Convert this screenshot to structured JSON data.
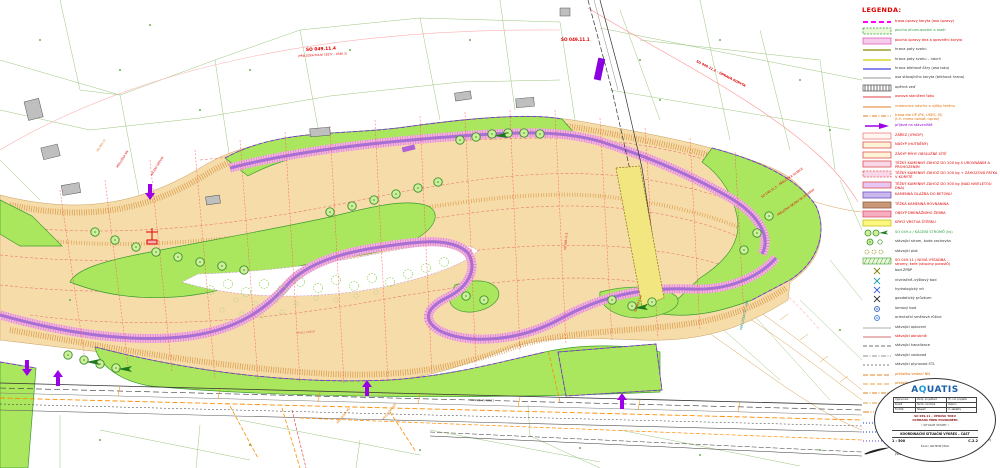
{
  "colors": {
    "corridor_fill": "#F6DCA8",
    "hatch_orange": "#D89848",
    "green_area": "#ABE65F",
    "green_border": "#3C9B2F",
    "riprap_pink": "#F2B6E2",
    "riprap_tick": "#E07FB8",
    "channel_violet": "#A86FD4",
    "arrow_purple": "#9B00E8",
    "annotation_red": "#E00000",
    "utility_orange": "#E07000",
    "road_yellow": "#F2E680",
    "cadastre_green": "#8FBF6F",
    "axis_pink": "#FF9090",
    "building_grey": "#BFBFBF",
    "teal_note": "#109090"
  },
  "legend": {
    "title": "LEGENDA:",
    "items": [
      {
        "sw": {
          "k": "dash",
          "c": "#FF00FF",
          "w": 2,
          "d": "5,3"
        },
        "t": "trasa úpravy koryta (osa úpravy)",
        "tc": "#E00000"
      },
      {
        "sw": {
          "k": "rectdash",
          "f": "#EAF7D8",
          "c": "#2E9E40"
        },
        "t": "plocha ohumusování a osetí",
        "tc": "#2E9E40"
      },
      {
        "sw": {
          "k": "rect",
          "f": "#F6CCEA",
          "c": "#E060C0"
        },
        "t": "plocha úpravy dna a opevnění koryta",
        "tc": "#E00000"
      },
      {
        "sw": {
          "k": "line",
          "c": "#8A8A00",
          "w": 1.2
        },
        "t": "hrana paty svahu",
        "tc": "#333333"
      },
      {
        "sw": {
          "k": "line",
          "c": "#CFCF00",
          "w": 1.2
        },
        "t": "hrana paty svahu – návrh",
        "tc": "#333333"
      },
      {
        "sw": {
          "k": "line",
          "c": "#4040E0",
          "w": 1.2
        },
        "t": "hrana břehové čáry (osa toku)",
        "tc": "#333333"
      },
      {
        "sw": {
          "k": "line",
          "c": "#707070",
          "w": 0.8
        },
        "t": "osa stávajícího koryta (břehová hrana)",
        "tc": "#333333"
      },
      {
        "sw": {
          "k": "hatch"
        },
        "t": "opěrná zeď",
        "tc": "#333333"
      },
      {
        "sw": {
          "k": "line",
          "c": "#E04040",
          "w": 1
        },
        "t": "osnova staničení toku",
        "tc": "#E00000"
      },
      {
        "sw": {
          "k": "line",
          "c": "#E08020",
          "w": 1
        },
        "t": "vrstevnice návrhu a výšky terénu",
        "tc": "#E07000"
      },
      {
        "sw": {
          "k": "dashdot",
          "c": "#E08020",
          "w": 1
        },
        "t": "trasa dle ÚP (PK, ÚSES, IS)\n(t.č. mimo rozsah úprav)",
        "tc": "#E07000"
      },
      {
        "sw": {
          "k": "arrow"
        },
        "t": "příjezd na staveniště",
        "tc": "#9400D3"
      },
      {
        "sw": {
          "k": "rect",
          "f": "#FFF6F0",
          "c": "#F08080"
        },
        "t": "ZÁŘEZ (VÝKOP)",
        "tc": "#E00000"
      },
      {
        "sw": {
          "k": "rect",
          "f": "#FDF3D8",
          "c": "#E05050"
        },
        "t": "NÁSYP (HUTNĚNÝ)",
        "tc": "#E00000"
      },
      {
        "sw": {
          "k": "rect",
          "f": "#FDF3D8",
          "c": "#E05050"
        },
        "t": "ZÁSYP RÝHY OBSLUŽNÉ SÍTĚ",
        "tc": "#E00000"
      },
      {
        "sw": {
          "k": "rect",
          "f": "#F8D8E8",
          "c": "#E05050"
        },
        "t": "TĚŽKÝ KAMENNÝ ZÁHOZ DO 200 kg S UROVNÁNÍM A PROHOZENÍM",
        "tc": "#E00000"
      },
      {
        "sw": {
          "k": "rectdash",
          "f": "#F8D8E8",
          "c": "#E05050"
        },
        "t": "TĚŽKÝ KAMENNÝ ZÁHOZ DO 200 kg + ZÁHOZOVÁ PATKA V KORYTĚ",
        "tc": "#E00000"
      },
      {
        "sw": {
          "k": "rect",
          "f": "#E6C6F2",
          "c": "#E05050"
        },
        "t": "TĚŽKÝ KAMENNÝ ZÁHOZ DO 500 kg (NAD NIVELETOU DNA)",
        "tc": "#E00000"
      },
      {
        "sw": {
          "k": "rect",
          "f": "#C9B8EE",
          "c": "#7050C0"
        },
        "t": "KAMENNÁ DLAŽBA DO BETONU",
        "tc": "#E00000"
      },
      {
        "sw": {
          "k": "rect",
          "f": "#C89878",
          "c": "#906040"
        },
        "t": "TĚŽKÁ KAMENNÁ ROVNANINA",
        "tc": "#E00000"
      },
      {
        "sw": {
          "k": "rect",
          "f": "#F4AEC0",
          "c": "#E05070"
        },
        "t": "OBSYP DRENÁŽNÍHO ŽEBRA",
        "tc": "#E00000"
      },
      {
        "sw": {
          "k": "rect",
          "f": "#FBF77E",
          "c": "#C8C020"
        },
        "t": "KRYCÍ VRSTVA ŠTĚRKU",
        "tc": "#E00000"
      },
      {
        "sw": {
          "k": "treegrp"
        },
        "t": "SO 049.x / KÁCENÍ STROMŮ (ks)",
        "tc": "#2E9E40"
      },
      {
        "sw": {
          "k": "tree2"
        },
        "t": "stávající strom, bude zachován",
        "tc": "#333333"
      },
      {
        "sw": {
          "k": "shrub"
        },
        "t": "stávající plot",
        "tc": "#333333"
      },
      {
        "sw": {
          "k": "grove"
        },
        "t": "SO 049.11 / NOVÁ VÝSADBA –\nstromy, keře (skupiny porostů)",
        "tc": "#E00000"
      },
      {
        "sw": {
          "k": "pt",
          "c": "#808000"
        },
        "t": "bod ZPBP",
        "tc": "#333333"
      },
      {
        "sw": {
          "k": "pt",
          "c": "#20A0A0"
        },
        "t": "nivelačně–výškový bod",
        "tc": "#333333"
      },
      {
        "sw": {
          "k": "pt",
          "c": "#4060E0"
        },
        "t": "hydrologický vrt",
        "tc": "#333333"
      },
      {
        "sw": {
          "k": "pt",
          "c": "#333333"
        },
        "t": "geodetický průzkum",
        "tc": "#333333"
      },
      {
        "sw": {
          "k": "pt2",
          "c": "#2050C0"
        },
        "t": "lomový bod",
        "tc": "#333333"
      },
      {
        "sw": {
          "k": "pt2",
          "c": "#3070E0"
        },
        "t": "orientační směrová růžice",
        "tc": "#333333"
      },
      {
        "sw": {
          "k": "line",
          "c": "#909090",
          "w": 0.8
        },
        "t": "stávající oplocení",
        "tc": "#333333"
      },
      {
        "sw": {
          "k": "line",
          "c": "#C04040",
          "w": 0.8
        },
        "t": "stávající obrubník",
        "tc": "#E00000"
      },
      {
        "sw": {
          "k": "dash",
          "c": "#707070",
          "w": 0.9,
          "d": "4,2"
        },
        "t": "stávající kanalizace",
        "tc": "#333333"
      },
      {
        "sw": {
          "k": "dashdot",
          "c": "#909090",
          "w": 0.9
        },
        "t": "stávající vodovod",
        "tc": "#333333"
      },
      {
        "sw": {
          "k": "dash",
          "c": "#808080",
          "w": 0.9,
          "d": "2,2"
        },
        "t": "stávající plynovod STL",
        "tc": "#333333"
      },
      {
        "sw": {
          "k": "dash",
          "c": "#E08020",
          "w": 1,
          "d": "5,2"
        },
        "t": "přeložka vedení NN",
        "tc": "#E07000"
      },
      {
        "sw": {
          "k": "dash",
          "c": "#E0A040",
          "w": 1,
          "d": "5,2"
        },
        "t": "přeložka plynovodu STL",
        "tc": "#E07000"
      },
      {
        "sw": {
          "k": "dashdot",
          "c": "#E08020",
          "w": 1
        },
        "t": "přeložka vedení VO",
        "tc": "#E07000"
      },
      {
        "sw": {
          "k": "dashdot",
          "c": "#E0A040",
          "w": 1
        },
        "t": "přeložka vodovodu",
        "tc": "#E07000"
      },
      {
        "sw": {
          "k": "dashdot2",
          "c": "#E08020",
          "w": 1
        },
        "t": "přeložka vedení SEK – telekom.\npřeložka veřejného osvětlení",
        "tc": "#E07000"
      },
      {
        "sw": {
          "k": "dots",
          "c": "#4060E0"
        },
        "t": "hranice parcel dle KN (ISKN)",
        "tc": "#333333"
      },
      {
        "sw": {
          "k": "dots",
          "c": "#4060E0"
        },
        "t": "hranice vnějšího obvodu stavby (trvalý zábor)",
        "tc": "#333333"
      },
      {
        "sw": {
          "k": "dots",
          "c": "#8060E0"
        },
        "t": "hranice pozemků dotčených stavbou (dočasný zábor)",
        "tc": "#333333"
      },
      {
        "sw": {
          "k": "sig"
        },
        "t": "směr toku\n(stávající koryto)",
        "tc": "#333333"
      }
    ]
  },
  "titleblock": {
    "company": "A",
    "company_globe": "Q",
    "company_rest": "UATIS",
    "table": [
      [
        "Vypracoval",
        "Zodp. projektant",
        "Hl. inž. projektu"
      ],
      [
        "Kreslil",
        "Techn. kontrola",
        "Datum"
      ],
      [
        "Formát",
        "Stupeň",
        "Č. zakázky"
      ]
    ],
    "line1": "SO 049.11 – ÚPRAVA TOKU",
    "line2": "OCHRANA PŘED POVODNĚMI",
    "line3": "( SITUACE STAVBY )",
    "main_title": "KOORDINAČNÍ SITUAČNÍ VÝKRES – ČÁST",
    "scale_label": "1 : 500",
    "drawing_no": "C.2.2",
    "doc_code": "8×A4 / ARCHIVNÍ ČÍSLO"
  },
  "map": {
    "annotations": [
      {
        "text": "SO 049.11.4",
        "x": 306,
        "y": 51,
        "r": -3,
        "c": "#E00000",
        "s": 4.4,
        "b": 1
      },
      {
        "text": "(PŘELOŽKA POLNÍ CESTY – ÚSEK 2)",
        "x": 298,
        "y": 57,
        "r": -3,
        "c": "#E00000",
        "s": 2.8,
        "b": 0
      },
      {
        "text": "SO 049.11.1",
        "x": 561,
        "y": 41,
        "r": 0,
        "c": "#E00000",
        "s": 4.2,
        "b": 1
      },
      {
        "text": "SO 049.11.2 – ÚPRAVA KORYTA",
        "x": 696,
        "y": 62,
        "r": 27,
        "c": "#E00000",
        "s": 3.2,
        "b": 1
      },
      {
        "text": "SO 049.11.3 – PŘELOŽKA SILNICE",
        "x": 762,
        "y": 198,
        "r": -35,
        "c": "#E00000",
        "s": 3,
        "b": 0
      },
      {
        "text": "PŘELOŽKA SJEZDU NA POZEMKY",
        "x": 778,
        "y": 216,
        "r": -35,
        "c": "#E00000",
        "s": 2.8,
        "b": 0
      },
      {
        "text": "PŘELOŽKA O2 – SEK",
        "x": 742,
        "y": 330,
        "r": -78,
        "c": "#109090",
        "s": 3,
        "b": 0
      },
      {
        "text": "PŘELOŽKA NN",
        "x": 118,
        "y": 168,
        "r": -58,
        "c": "#E00000",
        "s": 2.8,
        "b": 0
      },
      {
        "text": "SO 461.11",
        "x": 98,
        "y": 152,
        "r": -58,
        "c": "#E07000",
        "s": 2.8,
        "b": 0
      },
      {
        "text": "KÁCENÍ DŘEVIN",
        "x": 152,
        "y": 176,
        "r": -58,
        "c": "#E00000",
        "s": 2.8,
        "b": 0
      },
      {
        "text": "PŘELOŽKA VO",
        "x": 338,
        "y": 424,
        "r": -52,
        "c": "#E07000",
        "s": 2.8,
        "b": 0
      },
      {
        "text": "PŘELOŽKA NN",
        "x": 384,
        "y": 420,
        "r": -52,
        "c": "#E07000",
        "s": 2.8,
        "b": 0
      },
      {
        "text": "SO 049.11.5",
        "x": 566,
        "y": 250,
        "r": -85,
        "c": "#E00000",
        "s": 2.8,
        "b": 0
      },
      {
        "text": "TRVALÝ ZÁBOR",
        "x": 296,
        "y": 334,
        "r": -5,
        "c": "#E06060",
        "s": 2.6,
        "b": 0
      },
      {
        "text": "SILNICE III/43911",
        "x": 470,
        "y": 401,
        "r": 1,
        "c": "#333333",
        "s": 2.8,
        "b": 0
      },
      {
        "text": "SO 049.11.6",
        "x": 636,
        "y": 312,
        "r": -70,
        "c": "#E00000",
        "s": 2.8,
        "b": 0
      }
    ],
    "arrows": [
      {
        "x": 27,
        "y": 376,
        "d": "down"
      },
      {
        "x": 58,
        "y": 386,
        "d": "up"
      },
      {
        "x": 150,
        "y": 200,
        "d": "down"
      },
      {
        "x": 367,
        "y": 396,
        "d": "up"
      },
      {
        "x": 622,
        "y": 409,
        "d": "up"
      }
    ]
  }
}
